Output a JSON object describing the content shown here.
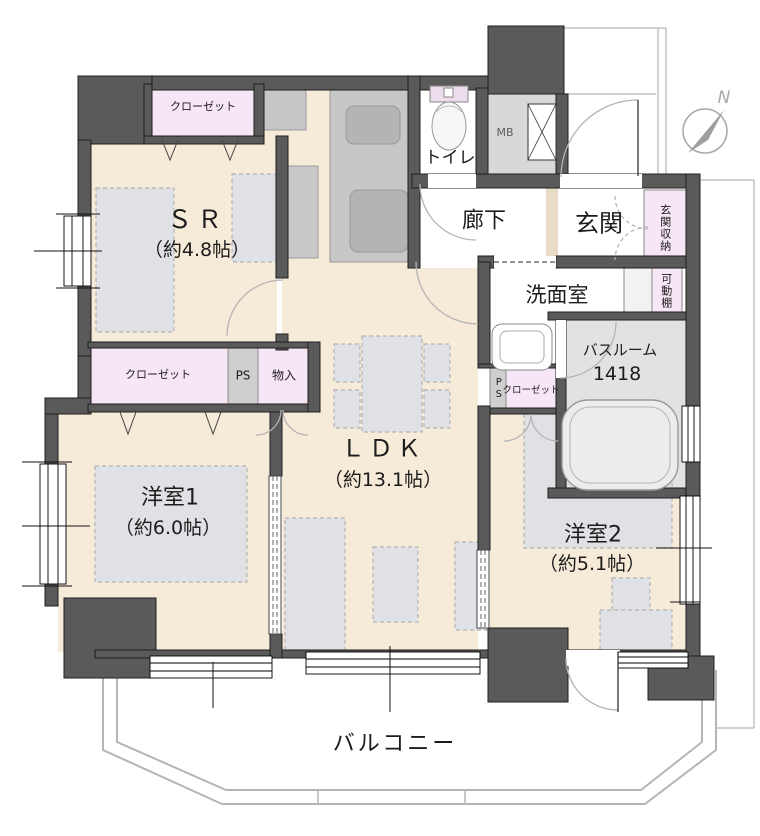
{
  "rooms": {
    "sr": {
      "name": "ＳＲ",
      "size": "（約4.8帖）"
    },
    "ldk": {
      "name": "ＬＤＫ",
      "size": "（約13.1帖）"
    },
    "bedroom1": {
      "name": "洋室1",
      "size": "（約6.0帖）"
    },
    "bedroom2": {
      "name": "洋室2",
      "size": "（約5.1帖）"
    },
    "toilet": {
      "name": "トイレ"
    },
    "hallway": {
      "name": "廊下"
    },
    "entrance": {
      "name": "玄関"
    },
    "washroom": {
      "name": "洗面室"
    },
    "bathroom": {
      "name": "バスルーム",
      "size": "1418"
    },
    "balcony": {
      "name": "バルコニー"
    }
  },
  "storage": {
    "sr_closet": "クローゼット",
    "west_closet": "クローゼット",
    "bedroom2_closet": "クローゼット",
    "storeroom": "物入",
    "pipe_space_west": "PS",
    "pipe_space_bath": "PS",
    "entrance_storage": "玄関収納",
    "movable_shelf": "可動棚",
    "meter_box": "MB"
  },
  "compass": {
    "north_label": "N"
  },
  "colors": {
    "floor": "#f6ead8",
    "wall": "#5a5a5a",
    "closet": "#f6e6f6",
    "wet_floor": "#ffffff",
    "bath_floor": "#e2e2e2",
    "furniture": "#dfe1e4",
    "balcony_line": "#b5b5b5"
  }
}
